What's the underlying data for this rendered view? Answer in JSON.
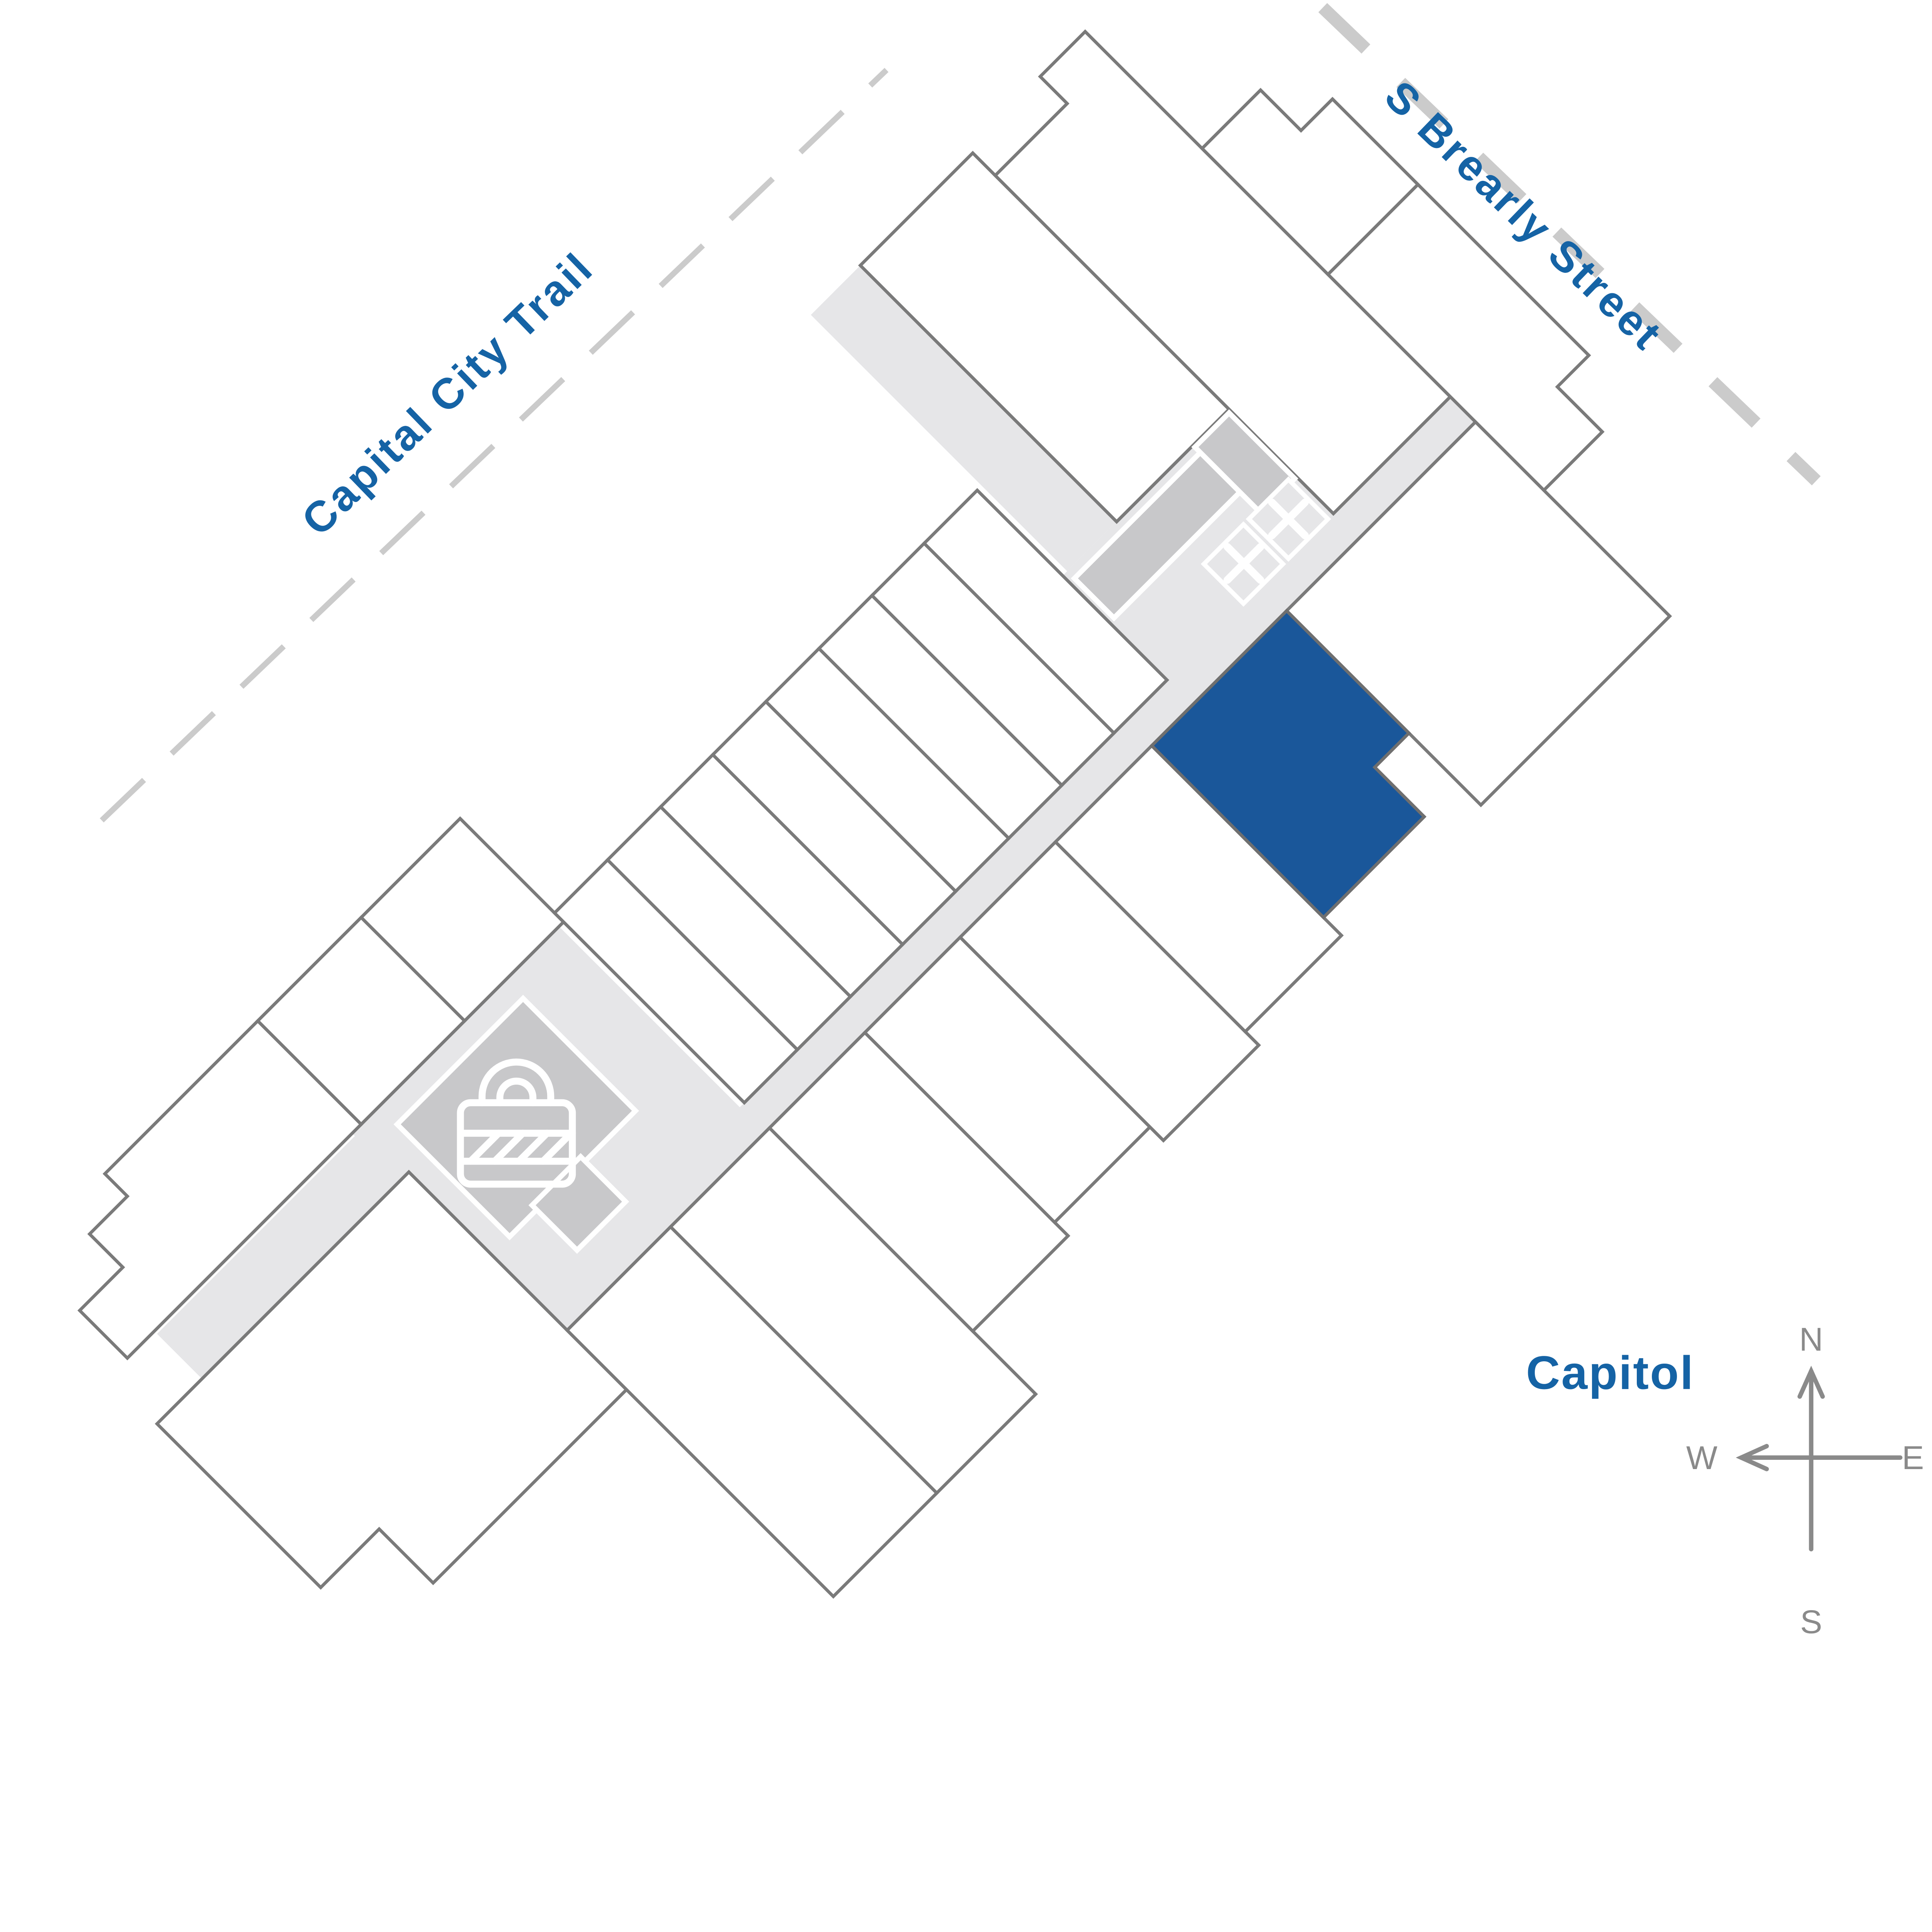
{
  "streets": {
    "capital_city_trail": {
      "label": "Capital City Trail"
    },
    "s_brearly_street": {
      "label": "S Brearly Street"
    }
  },
  "landmarks": {
    "capitol": "Capitol"
  },
  "compass": {
    "north": "N",
    "south": "S",
    "east": "E",
    "west": "W"
  },
  "selected_unit": {
    "highlight_color": "#1a579a"
  },
  "colors": {
    "label_blue": "#1563a5",
    "wall_gray": "#7a7a7a",
    "corridor_gray": "#e6e6e8",
    "room_gray": "#c8c8ca",
    "dash_gray": "#cbcbcb",
    "compass_gray": "#8a8a8a"
  },
  "icons": {
    "lock": "lock-icon",
    "stair_room": "x-room-icon"
  }
}
